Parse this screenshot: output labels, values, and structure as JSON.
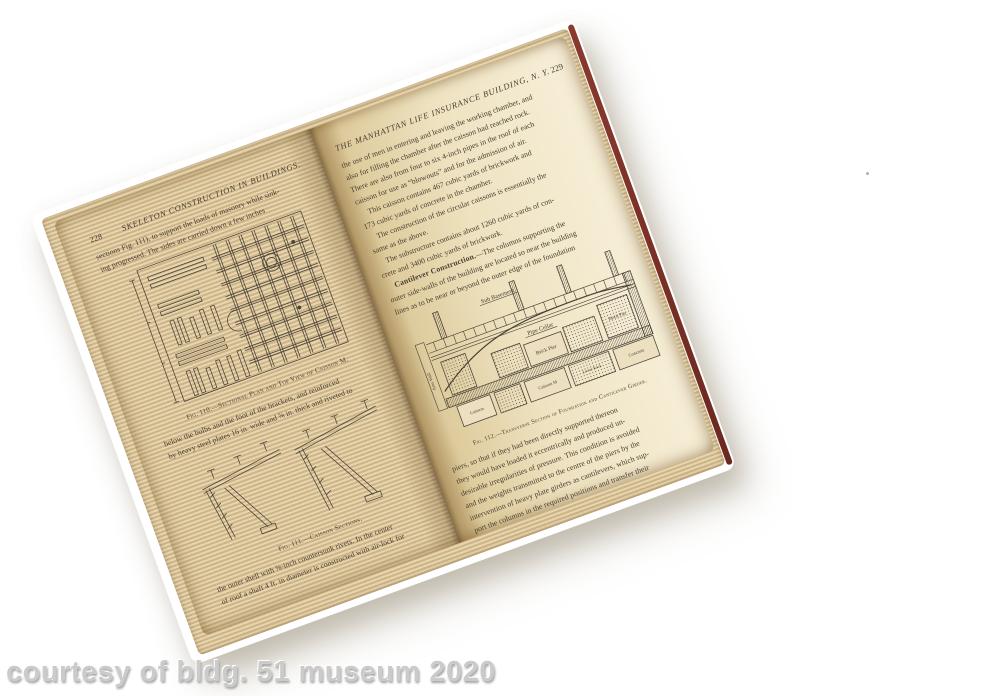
{
  "watermark": "courtesy of bldg. 51 museum 2020",
  "book": {
    "left_page": {
      "page_number": "228",
      "running_header": "SKELETON CONSTRUCTION IN BUILDINGS.",
      "para_top": [
        {
          "t": "sections Fig. 111), to support the loads of masonry while sink-"
        },
        {
          "t": "ing progressed.  The sides are carried down a few inches"
        }
      ],
      "fig110": {
        "caption": "Fig. 110.—Sectional Plan and Top View of Caisson M."
      },
      "para_mid": [
        {
          "t": "below the bulbs and the foot of the brackets, and reinforced"
        },
        {
          "t": "by heavy steel plates 16 in. wide and ⅝ in. thick and riveted to"
        }
      ],
      "fig111": {
        "caption": "Fig. 111.—Caisson Sections."
      },
      "para_bottom": [
        {
          "t": "the outer shell with ⅝-inch countersunk rivets.  In the center"
        },
        {
          "t": "of roof a shaft 4 ft. in diameter is constructed with air-lock for"
        }
      ]
    },
    "right_page": {
      "page_number": "229",
      "running_header": "THE MANHATTAN LIFE INSURANCE BUILDING, N. Y.",
      "para_top": [
        {
          "t": "the use of men in entering and leaving the working chamber, and"
        },
        {
          "t": "also for filling the chamber after the caisson had reached rock."
        },
        {
          "t": "There are also from four to six 4-inch pipes in the roof of each"
        },
        {
          "t": "caisson for use as “blowouts” and for the admission of air."
        },
        {
          "t": "This caisson contains 467 cubic yards of brickwork and",
          "in": true
        },
        {
          "t": "173 cubic yards of concrete in the chamber."
        },
        {
          "t": "The construction of the circular caissons is essentially the",
          "in": true
        },
        {
          "t": "same as the above."
        },
        {
          "t": "The substructure contains about 1260 cubic yards of con-",
          "in": true
        },
        {
          "t": "crete and 3400 cubic yards of brickwork."
        },
        {
          "t": "—The columns supporting the",
          "in": true,
          "lead": "Cantilever Construction."
        },
        {
          "t": "outer side-walls of the building are located so near the building"
        },
        {
          "t": "lines as to be near or beyond the outer edge of the foundation"
        }
      ],
      "fig112": {
        "caption": "Fig. 112.—Transverse Section of Foundation and Cantilever Girder.",
        "labels": {
          "sub_basement": "Sub Basement",
          "pipe_cellar": "Pipe Cellar",
          "brick_pier": "Brick Pier",
          "brick_pier2": "Brick Pier",
          "area_wall": "Area Wall",
          "caisson": "Caisson",
          "caisson_m": "Caisson M",
          "loose_rock": "Loose Rock",
          "concrete": "Concrete"
        }
      },
      "para_bottom": [
        {
          "t": "piers, so that if they had been directly supported thereon"
        },
        {
          "t": "they would have loaded it eccentrically and produced un-"
        },
        {
          "t": "desirable irregularities of pressure.  This condition is avoided"
        },
        {
          "t": "and the weights transmitted to the centre of the piers by the"
        },
        {
          "t": "intervention of heavy plate girders as cantilevers, which sup-"
        },
        {
          "t": "port the columns in the required positions and transfer their"
        }
      ]
    }
  },
  "colors": {
    "page": "#ecdfbc",
    "cover": "#47201a",
    "ink": "#4b4337",
    "watermark": "#cbcbcb"
  }
}
